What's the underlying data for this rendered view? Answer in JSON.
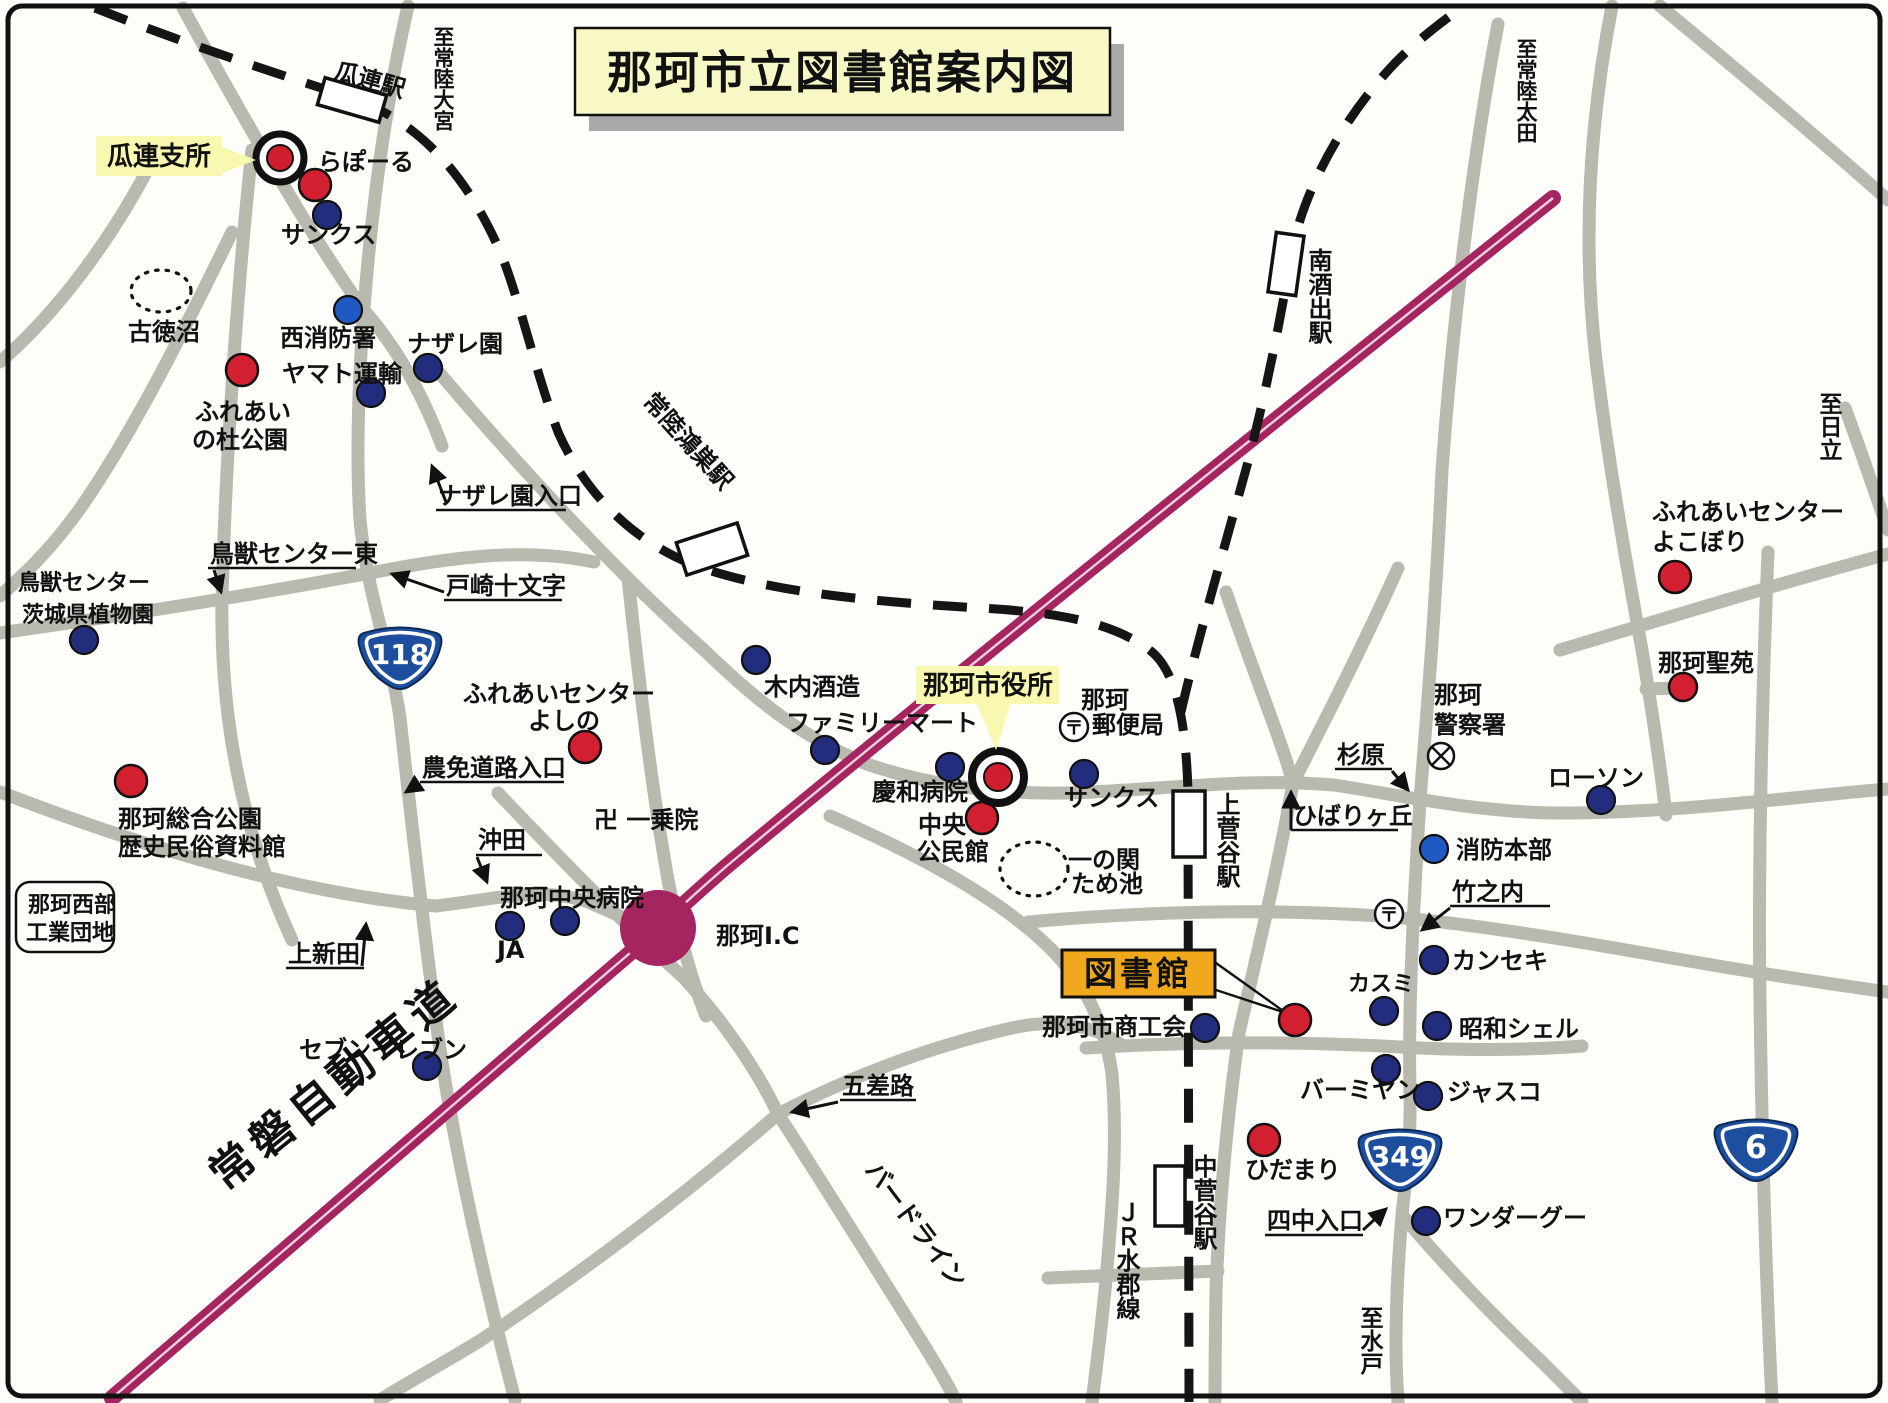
{
  "title": "那珂市立図書館案内図",
  "highlight": {
    "urizura_branch": "瓜連支所",
    "city_hall": "那珂市役所",
    "library": "図書館"
  },
  "stations": {
    "urizura": "瓜連駅",
    "hitachi_konosu": "常陸鴻巣駅",
    "minami_sakaide": "南酒出駅",
    "kami_sugaya": "上菅谷駅",
    "naka_sugaya": "中菅谷駅"
  },
  "rail_line": "ＪＲ水郡線",
  "expressway": "常磐自動車道",
  "interchange": "那珂I.C",
  "road_label": "バードライン",
  "shields": {
    "r118": "118",
    "r349": "349",
    "r6": "6"
  },
  "directions": {
    "hitachi_omiya": "至常陸大宮",
    "hitachi_ota": "至常陸太田",
    "hitachi": "至日立",
    "mito": "至水戸"
  },
  "inter": [
    {
      "name": "ナザレ園入口"
    },
    {
      "name": "鳥獣センター東"
    },
    {
      "name": "戸崎十文字"
    },
    {
      "name": "農免道路入口"
    },
    {
      "name": "沖田"
    },
    {
      "name": "上新田"
    },
    {
      "name": "五差路"
    },
    {
      "name": "杉原"
    },
    {
      "name": "ひばりヶ丘"
    },
    {
      "name": "竹之内"
    },
    {
      "name": "四中入口"
    }
  ],
  "poi_red": [
    {
      "name": "らぽーる"
    },
    {
      "line1": "ふれあい",
      "line2": "の杜公園"
    },
    {
      "line1": "那珂総合公園",
      "line2": "歴史民俗資料館"
    },
    {
      "line1": "ふれあいセンター",
      "line2": "よしの"
    },
    {
      "line1": "中央",
      "line2": "公民館"
    },
    {
      "name": "ひだまり"
    },
    {
      "line1": "ふれあいセンター",
      "line2": "よこぼり"
    },
    {
      "name": "那珂聖苑"
    }
  ],
  "poi_blue": [
    {
      "name": "サンクス"
    },
    {
      "name": "西消防署"
    },
    {
      "name": "ヤマト運輸"
    },
    {
      "name": "ナザレ園"
    },
    {
      "line1": "鳥獣センター",
      "line2": "茨城県植物園"
    },
    {
      "name": "木内酒造"
    },
    {
      "name": "ファミリーマート"
    },
    {
      "name": "慶和病院"
    },
    {
      "name": "サンクス"
    },
    {
      "name": "那珂中央病院"
    },
    {
      "name": "JA"
    },
    {
      "name": "セブンイレブン"
    },
    {
      "name": "那珂市商工会"
    },
    {
      "name": "カスミ"
    },
    {
      "name": "カンセキ"
    },
    {
      "name": "昭和シェル"
    },
    {
      "name": "バーミヤン"
    },
    {
      "name": "ジャスコ"
    },
    {
      "name": "ワンダーグー"
    },
    {
      "name": "消防本部"
    },
    {
      "name": "ローソン"
    }
  ],
  "other": {
    "post_office": {
      "line1": "那珂",
      "line2": "郵便局"
    },
    "police": {
      "line1": "那珂",
      "line2": "警察署"
    },
    "temple": "卍 一乗院",
    "pond1": "古徳沼",
    "pond2": {
      "line1": "一の関",
      "line2": "ため池"
    },
    "industrial": {
      "line1": "那珂西部",
      "line2": "工業団地"
    }
  },
  "marks": {
    "post_mark": "〒"
  }
}
